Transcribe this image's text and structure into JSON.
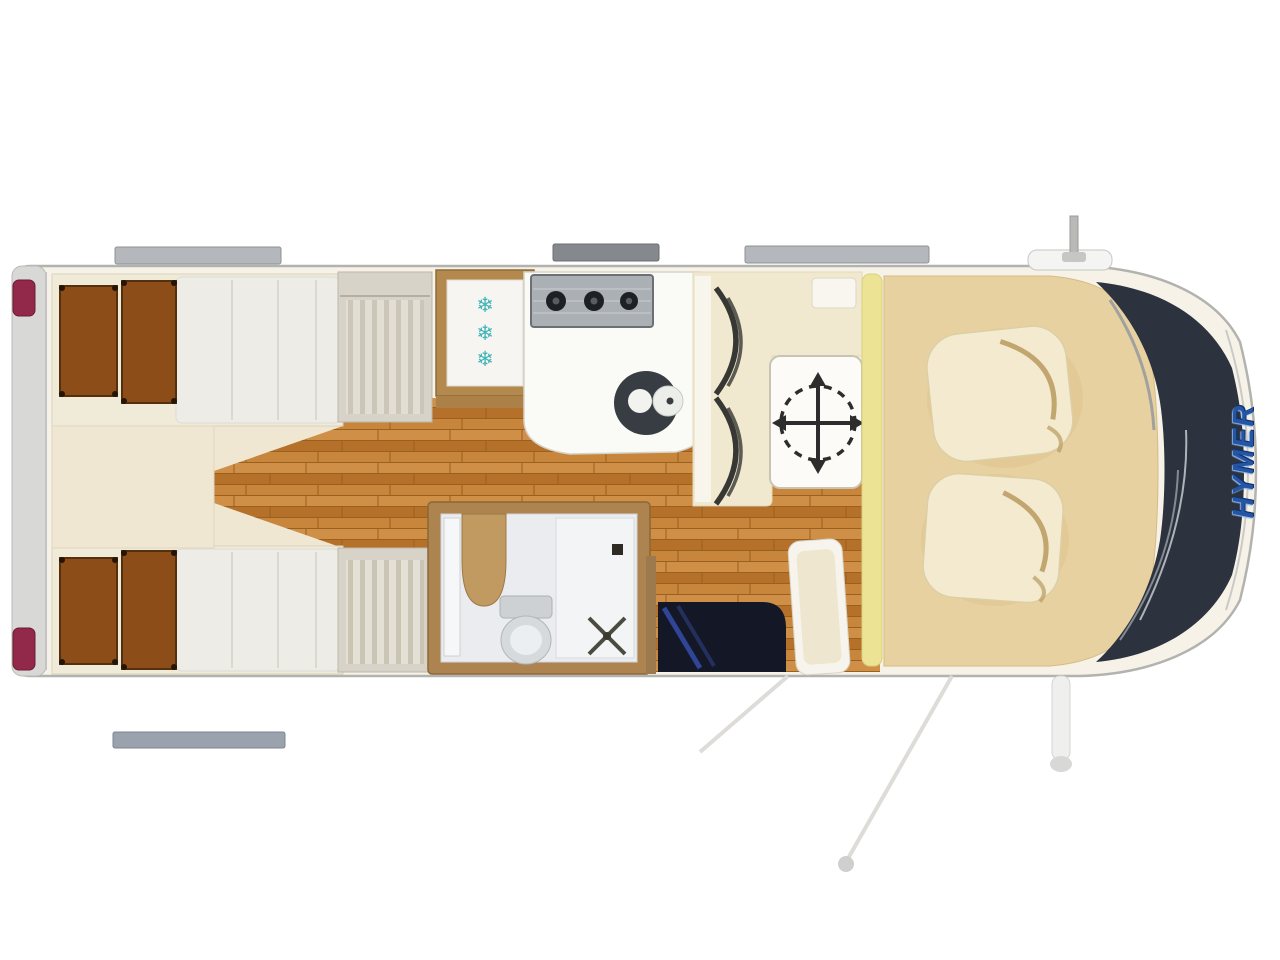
{
  "branding": {
    "logo_text": "HYMER",
    "logo_color": "#2456a6"
  },
  "fridge": {
    "snowflakes": [
      "❄",
      "❄",
      "❄"
    ],
    "snowflake_color": "#3fb3b6"
  },
  "colors": {
    "page_background": "#ffffff",
    "body_fill": "#f6f2e7",
    "body_outline": "#b2b2af",
    "rear_bumper": "#d8d8d6",
    "tail_light_red": "#93294a",
    "bed_pillow_brown": "#8d4d18",
    "bedding_cream": "#edece7",
    "wardrobe_grey": "#d8d3c9",
    "wood_floor": "#c17e36",
    "counter_white": "#fafaf7",
    "stove_grey": "#aab0b4",
    "sink_dark": "#383d44",
    "bathroom_frame": "#ad8450",
    "bathroom_interior": "#eaecef",
    "dinette_cream": "#f1e9cf",
    "bench_curve_dark": "#373733",
    "table_symbol": "#2d2d2d",
    "divider_yellow": "#ece394",
    "cab_carpet_tan": "#e8d1a1",
    "seat_cream": "#f3ead0",
    "entry_mat_navy": "#141826",
    "entry_mat_blue": "#3d58c8",
    "windshield_dark": "#2d333e",
    "roof_bar_grey": "#b4b7bb"
  }
}
